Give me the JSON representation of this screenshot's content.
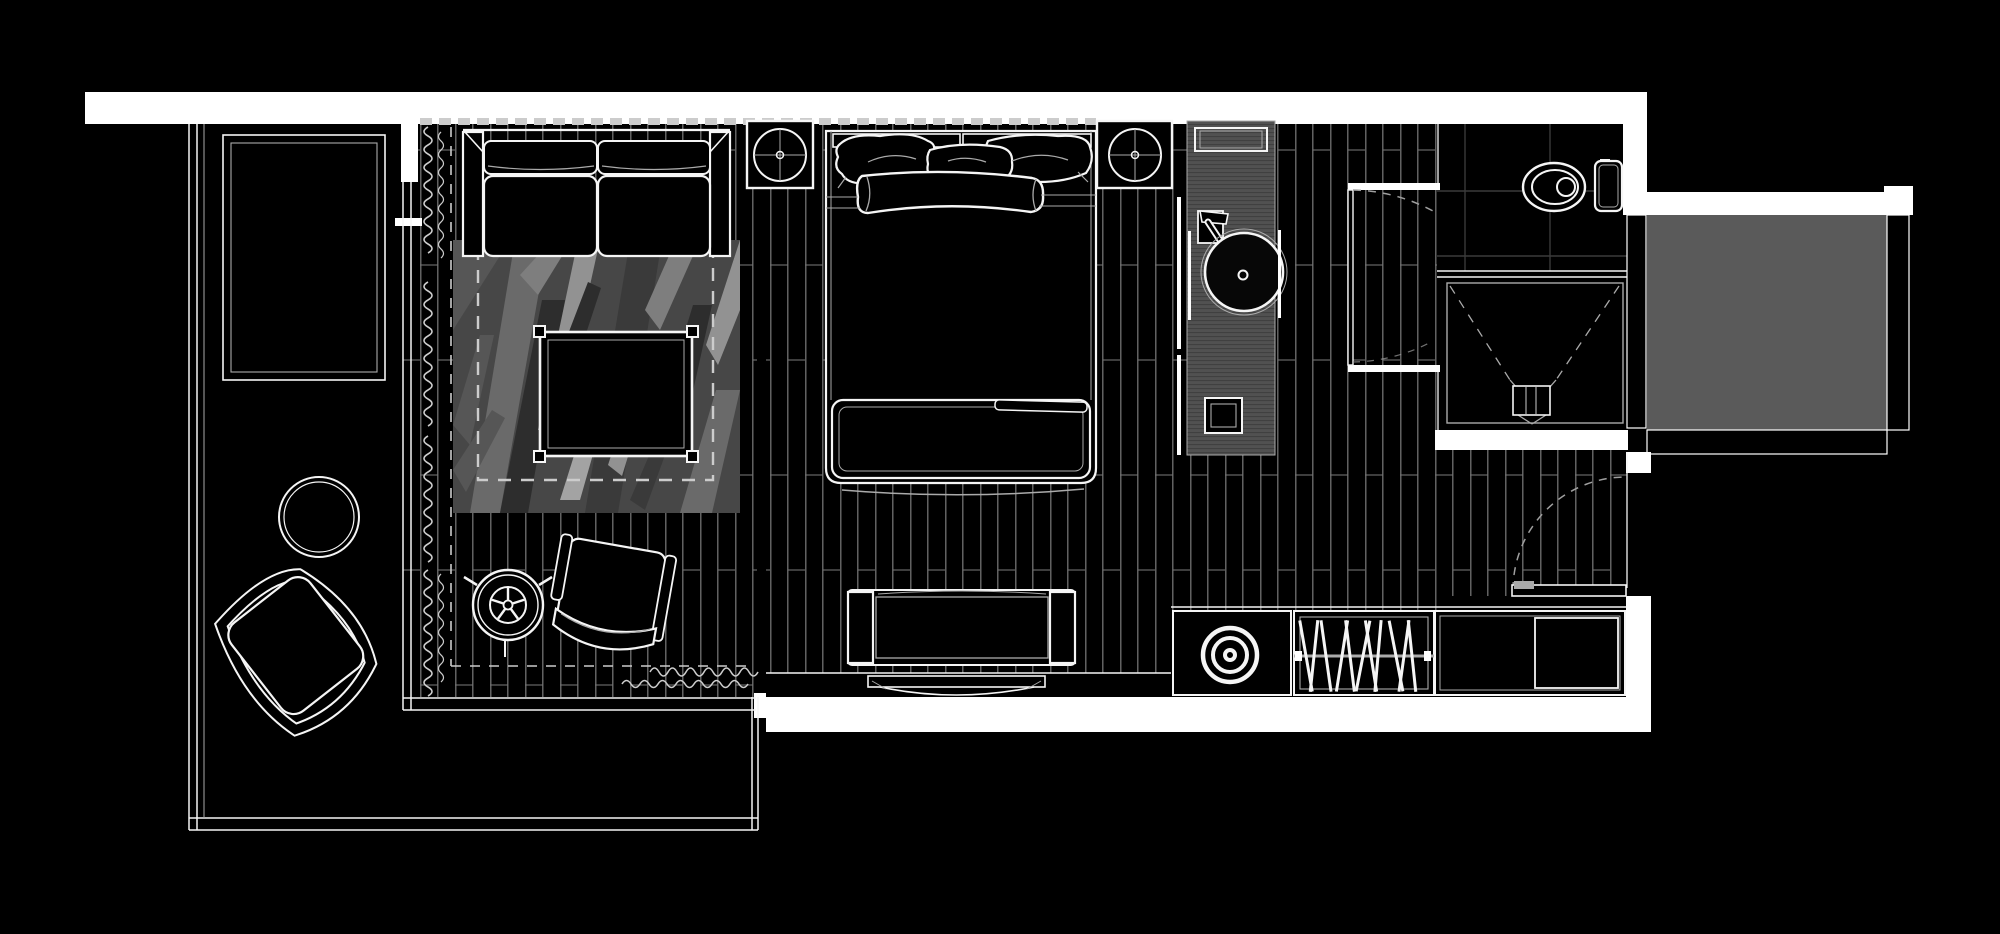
{
  "meta": {
    "kind": "architectural-floor-plan",
    "style": "dark line-art render, top-down studio suite"
  },
  "colors": {
    "bg": "#000000",
    "wall": "#ffffff",
    "line": "#f5f5f5",
    "faint": "#aaaaaa",
    "plank": "#8f8f8f",
    "joint": "#747474",
    "dash": "#cccccc",
    "arc": "#9f9f9f",
    "mat": "#5a5a5a",
    "vanity": "#515151",
    "vanityStripe": "#3e3e3e",
    "tile": "#3a3a3a",
    "rugBase": "#474747",
    "rug1": "#2d2d2d",
    "rug2": "#3a3a3a",
    "rug3": "#565656",
    "rug4": "#6a6a6a",
    "rug5": "#7e7e7e",
    "rug6": "#929292",
    "rug7": "#a3a3a3"
  },
  "zones": [
    {
      "id": "balcony-terrace"
    },
    {
      "id": "living-area"
    },
    {
      "id": "sleeping-area"
    },
    {
      "id": "dressing-corridor"
    },
    {
      "id": "bathroom"
    },
    {
      "id": "entry"
    },
    {
      "id": "outdoor-porch-mat"
    }
  ],
  "furniture": [
    "planter-daybed",
    "round-side-table",
    "lounge-chair",
    "spoke-stool",
    "armchair",
    "sofa",
    "coffee-table",
    "area-rug",
    "double-bed",
    "nightstand-left",
    "nightstand-right",
    "table-lamp",
    "foot-bench",
    "media-bench",
    "wall-tv",
    "vanity-counter",
    "round-basin",
    "faucet",
    "wardrobe-sink-cabinet",
    "wardrobe-hanger-cabinet",
    "wardrobe-cabinet",
    "toilet",
    "shower",
    "shower-drain",
    "curtains",
    "doors"
  ]
}
